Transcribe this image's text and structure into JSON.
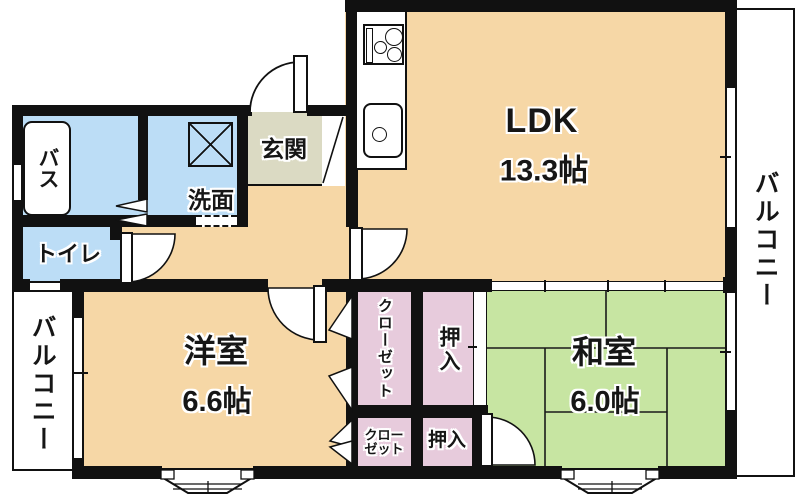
{
  "type": "apartment-floor-plan",
  "labels": {
    "ldk": "LDK",
    "ldk_size": "13.3帖",
    "western_room": "洋室",
    "western_size": "6.6帖",
    "japanese_room": "和室",
    "japanese_size": "6.0帖",
    "entrance": "玄関",
    "bath": "バス",
    "washroom": "洗面",
    "toilet": "トイレ",
    "balcony_right": "バルコニー",
    "balcony_left": "バルコニー",
    "closet_upper": "クローゼット",
    "closet_lower": "クローゼット",
    "oshiire_upper": "押入",
    "oshiire_lower": "押入"
  },
  "colors": {
    "wall": "#111111",
    "wood_floor": "#F6D7A6",
    "tatami": "#C7E5A2",
    "water_area": "#BCDDF6",
    "storage": "#E7CBDC",
    "entrance_floor": "#DBDAC3",
    "background": "#FFFFFF"
  }
}
